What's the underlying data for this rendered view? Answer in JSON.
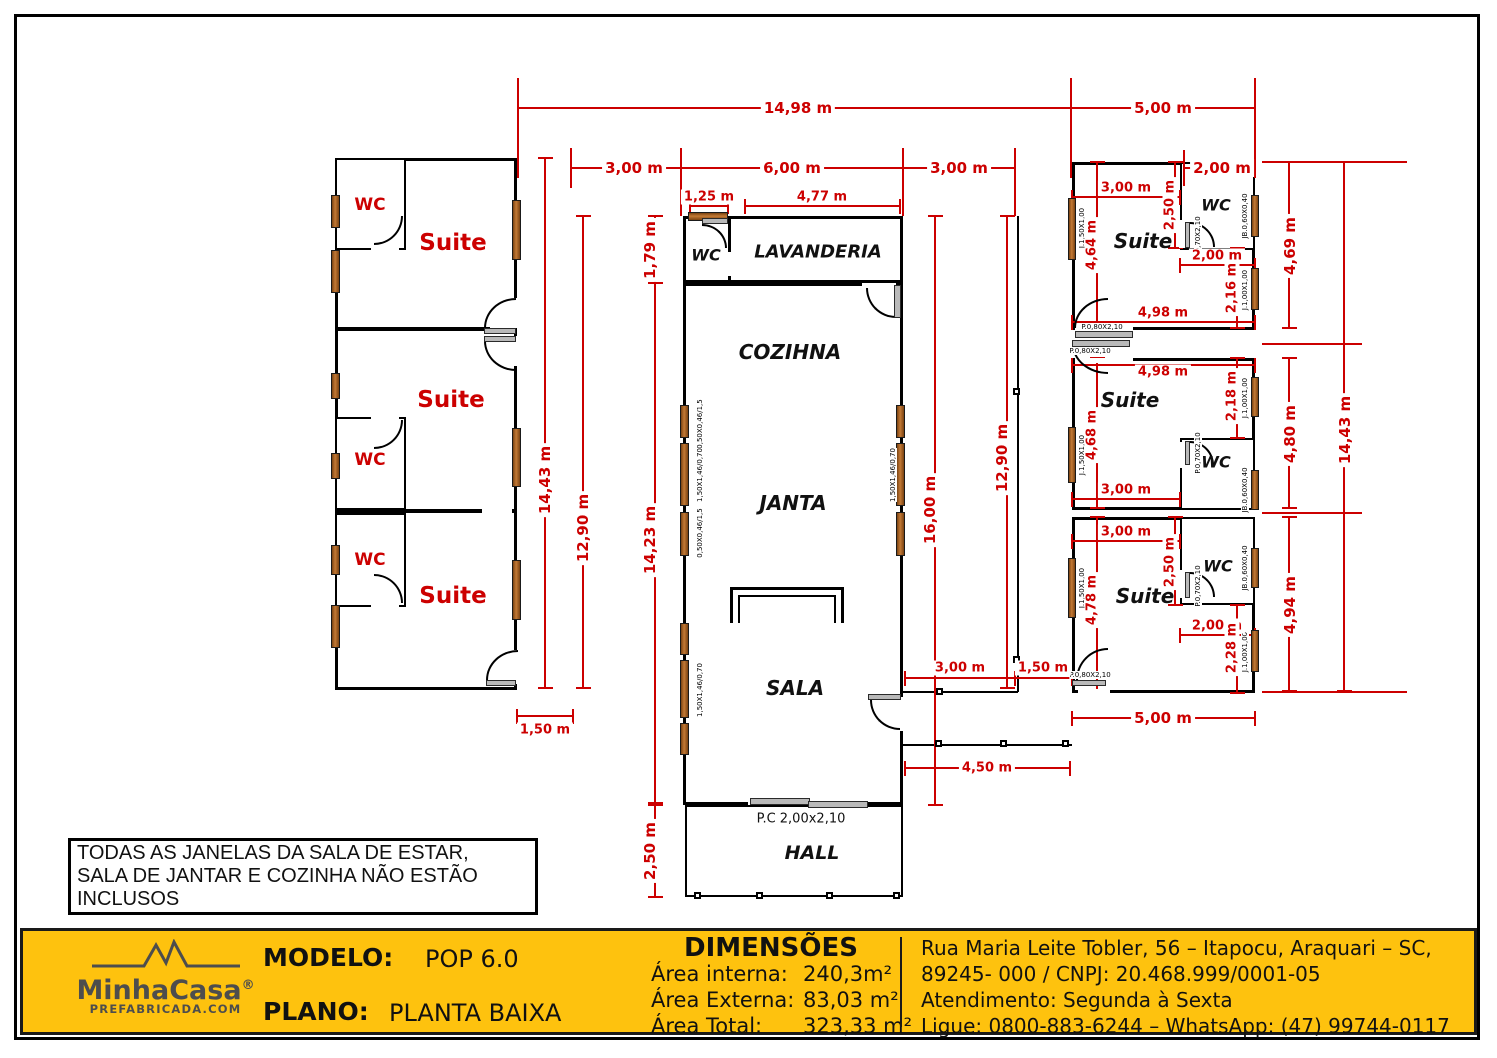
{
  "plan": {
    "rooms": {
      "suite": "Suite",
      "wc": "WC",
      "lavanderia": "LAVANDERIA",
      "cozinha": "COZIHNA",
      "janta": "JANTA",
      "sala": "SALA",
      "hall": "HALL"
    },
    "door_main_label": "P.C 2,00x2,10",
    "tags": {
      "window_large": "1,50X1,46/0,70",
      "window_small": "0,50X0,46/1,5",
      "j150": "J.1,50X1,00",
      "j100": "J.1,00X1,00",
      "jb": "JB.0,60X0,40",
      "p070": "P.0,70X2,10",
      "p080": "P.0,80X2,10"
    },
    "dims": {
      "d14_98": "14,98 m",
      "d5_00": "5,00 m",
      "d3_00": "3,00 m",
      "d6_00": "6,00 m",
      "d2_00": "2,00 m",
      "d14_43": "14,43 m",
      "d12_90": "12,90 m",
      "d1_50": "1,50 m",
      "d1_25": "1,25 m",
      "d4_77": "4,77 m",
      "d1_79": "1,79 m",
      "d14_23": "14,23 m",
      "d2_50": "2,50 m",
      "d16_00": "16,00 m",
      "d4_50": "4,50 m",
      "d4_98": "4,98 m",
      "d4_64": "4,64 m",
      "d2_16": "2,16 m",
      "d4_69": "4,69 m",
      "d2_18": "2,18 m",
      "d4_68": "4,68 m",
      "d4_80": "4,80 m",
      "d4_78": "4,78 m",
      "d2_28": "2,28 m",
      "d4_94": "4,94 m"
    }
  },
  "note": {
    "line1": "TODAS AS JANELAS DA SALA DE ESTAR,",
    "line2": "SALA DE JANTAR E COZINHA NÃO ESTÃO INCLUSOS"
  },
  "footer": {
    "logo": {
      "name": "MinhaCasa",
      "reg": "®",
      "sub": "PREFABRICADA.COM"
    },
    "modelo_label": "MODELO:",
    "modelo_value": "POP 6.0",
    "plano_label": "PLANO:",
    "plano_value": "PLANTA BAIXA",
    "dimensoes_title": "DIMENSÕES",
    "areas": [
      {
        "label": "Área interna:",
        "value": "240,3m²"
      },
      {
        "label": "Área Externa:",
        "value": "83,03 m²"
      },
      {
        "label": "Área Total:",
        "value": "323,33 m²"
      }
    ],
    "contact": [
      "Rua Maria Leite Tobler, 56 – Itapocu, Araquari – SC,",
      "89245- 000 / CNPJ: 20.468.999/0001-05",
      "Atendimento: Segunda à Sexta",
      "Ligue: 0800-883-6244 – WhatsApp: (47) 99744-0117"
    ],
    "colors": {
      "band": "#FEC20E",
      "accent_red": "#CC0000"
    }
  }
}
